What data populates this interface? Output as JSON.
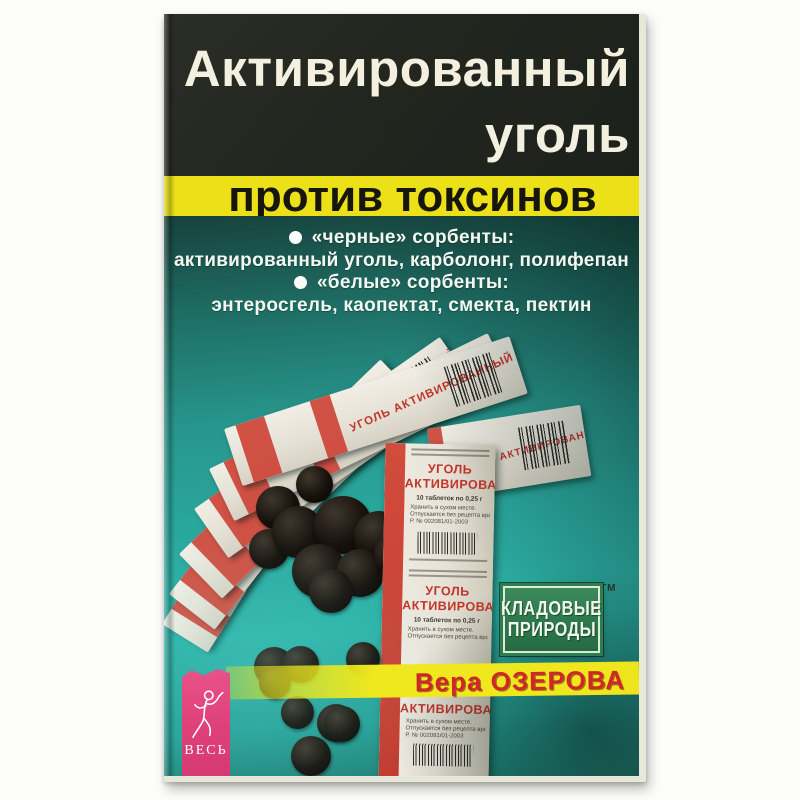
{
  "cover": {
    "title": {
      "line1": "Активированный",
      "line2": "уголь"
    },
    "subtitle": "против токсинов",
    "bullets": [
      {
        "heading": "«черные» сорбенты:",
        "items": "активированный уголь, карболонг, полифепан"
      },
      {
        "heading": "«белые» сорбенты:",
        "items": "энтеросгель, каопектат, смекта, пектин"
      }
    ],
    "author": "Вера ОЗЕРОВА",
    "badge": {
      "line1": "КЛАДОВЫЕ",
      "line2": "ПРИРОДЫ",
      "tm": "ТМ"
    },
    "publisher": "ВЕСЬ",
    "pack": {
      "title_line1": "УГОЛЬ",
      "title_line2": "АКТИВИРОВАННЫЙ",
      "title_full": "УГОЛЬ АКТИВИРОВАННЫЙ",
      "subtitle": "10 таблеток по 0,25 г",
      "note1": "Хранить в сухом месте.",
      "note2": "Отпускается без рецепта врача",
      "reg": "Р. № 002081/01-2003"
    },
    "colors": {
      "top_bg": "#22261f",
      "band_yellow": "#ece119",
      "teal": "#2aa89e",
      "pink": "#df4079",
      "badge_green": "#2f7c4f",
      "author_red": "#cf2629",
      "pack_red": "#cd4437"
    }
  }
}
